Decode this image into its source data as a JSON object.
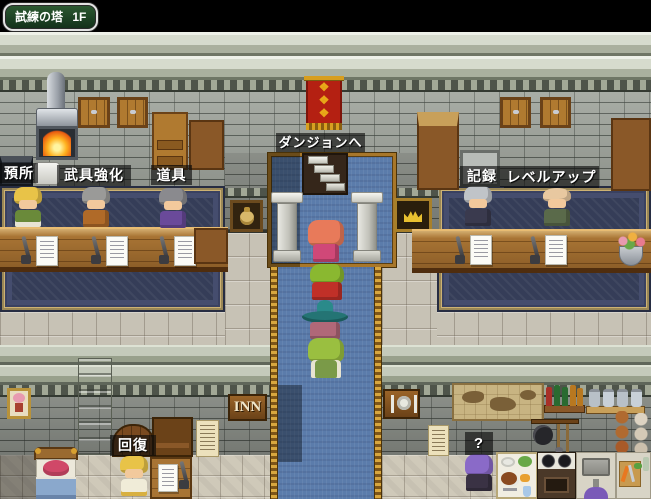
{
  "map_label": {
    "name": "試練の塔",
    "floor": "1F"
  },
  "service_labels": {
    "deposit": "預所",
    "equip_upgrade": "武具強化",
    "items": "道具",
    "to_dungeon": "ダンジョンへ",
    "record": "記録",
    "level_up": "レベルアップ",
    "heal": "回復",
    "mystery": "?"
  },
  "signs": {
    "inn": "INN"
  },
  "icons": {
    "left_counter_sign": "money-bag-icon",
    "right_counter_sign": "crown-icon",
    "restaurant_sign": "cutlery-icon"
  },
  "colors": {
    "void": "#000000",
    "label_bg": "rgba(10,10,10,0.62)",
    "label_text": "#ffffff",
    "map_label_bg1": "#2c5a32",
    "map_label_bg2": "#12301a",
    "map_label_border": "#e2e2e2",
    "stone_block": "#ccd1c3",
    "stone_brick": "#a2a79f",
    "stone_floor": "#c7c2b5",
    "flag_floor": "#cfc9b9",
    "carpet_navy": "#353d58",
    "carpet_blue": "#5b7cab",
    "carpet_gold": "#c89a3e",
    "counter_wood": "#a87434",
    "banner_red": "#b42012",
    "banner_gold": "#d89e1e"
  }
}
